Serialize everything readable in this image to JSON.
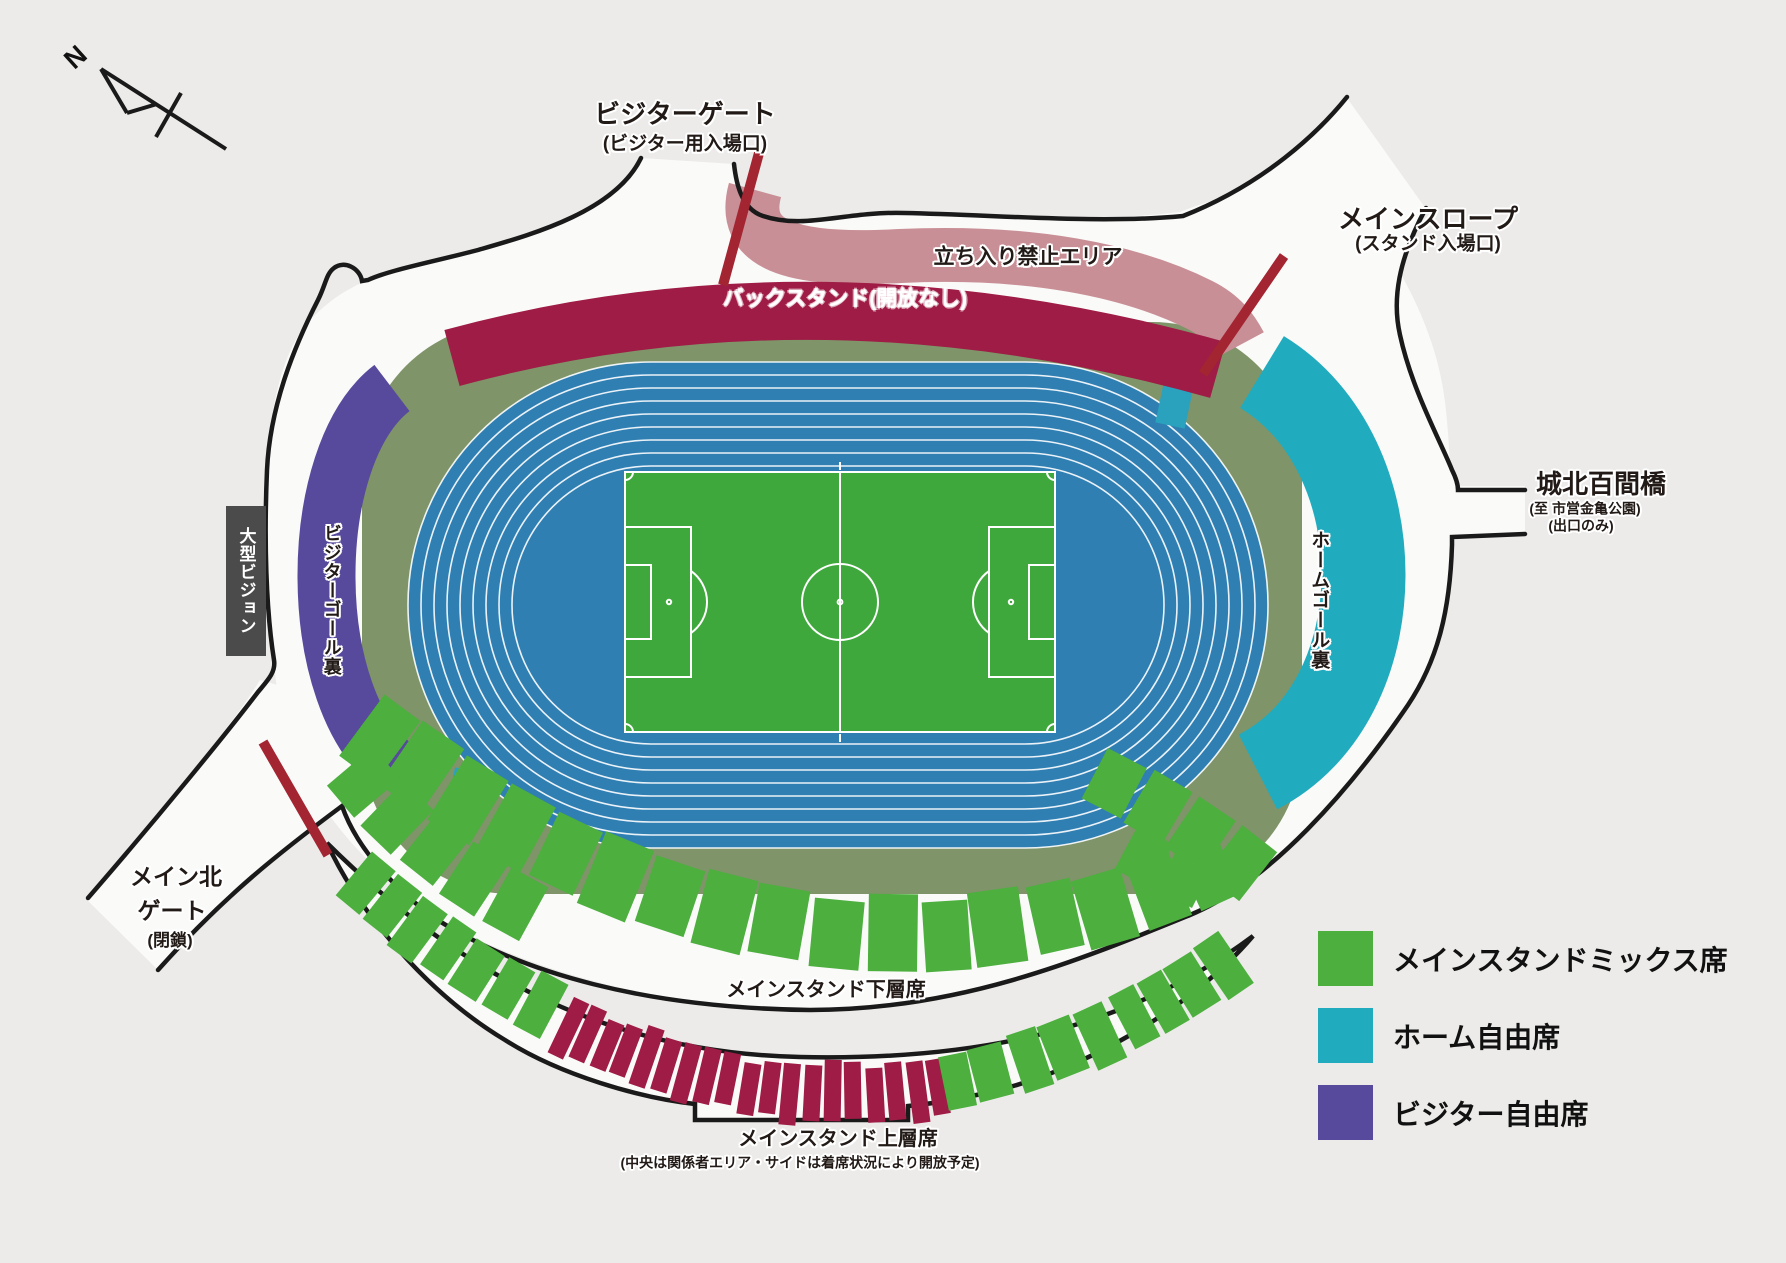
{
  "compass": {
    "label": "N"
  },
  "labels": {
    "visitor_gate": {
      "title": "ビジターゲート",
      "subtitle": "(ビジター用入場口)"
    },
    "main_slope": {
      "title": "メインスロープ",
      "subtitle": "(スタンド入場口)"
    },
    "no_entry": "立ち入り禁止エリア",
    "back_stand": "バックスタンド(開放なし)",
    "big_vision": "大型ビジョン",
    "visitor_goal_back": "ビジターゴール裏",
    "home_goal_back": "ホームゴール裏",
    "bridge": {
      "title": "城北百間橋",
      "subtitle1": "(至 市営金亀公園)",
      "subtitle2": "(出口のみ)"
    },
    "north_gate": {
      "line1": "メイン北",
      "line2": "ゲート",
      "line3": "(閉鎖)"
    },
    "lower_stand": "メインスタンド下層席",
    "upper_stand": "メインスタンド上層席",
    "upper_stand_note": "(中央は関係者エリア・サイドは着席状況により開放予定)"
  },
  "legend": {
    "items": [
      {
        "label": "メインスタンドミックス席",
        "color": "#4caf3e"
      },
      {
        "label": "ホーム自由席",
        "color": "#20acbe"
      },
      {
        "label": "ビジター自由席",
        "color": "#574a9c"
      }
    ]
  },
  "colors": {
    "background": "#ecebe9",
    "concourse": "#fafaf9",
    "outline": "#1a1a1a",
    "apron_green": "#7f9469",
    "track_blue": "#2f7fb3",
    "lane_line": "#ffffff",
    "pitch_green": "#3fa83c",
    "pitch_line": "#ffffff",
    "seat_green": "#4caf3e",
    "seat_crimson": "#9e1c45",
    "stand_back": "#9e1c45",
    "stand_restricted": "#c98f96",
    "stand_visitor": "#574a9c",
    "stand_home": "#20acbe",
    "gate_red": "#a32532",
    "screen_gray": "#4b4b4b",
    "track_marker": "#2aa2bd"
  }
}
